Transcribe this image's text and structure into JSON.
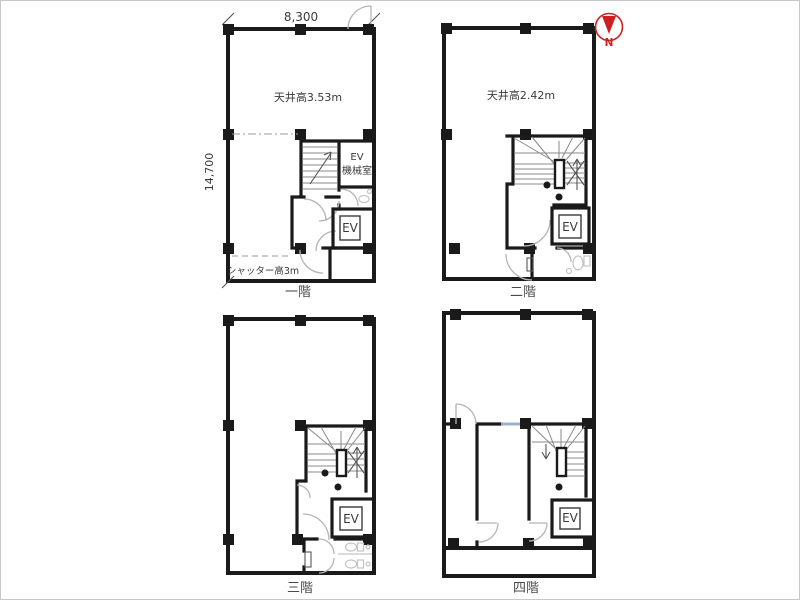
{
  "page": {
    "border_color": "#c8c8c8",
    "background": "#ffffff"
  },
  "colors": {
    "wall": "#1a1a1a",
    "stair_line": "#8a8a8a",
    "door_arc": "#b5b5b5",
    "fixture": "#c4c4c4",
    "dash": "#9a9a9a",
    "text": "#3a3a3a",
    "north_red": "#cc2020",
    "window_blue": "#9ab0cc",
    "border": "#c8c8c8"
  },
  "dimensions": {
    "width_label": "8,300",
    "height_label": "14,700"
  },
  "north_arrow": {
    "label": "N"
  },
  "floors": {
    "f1": {
      "name_label": "一階",
      "ceiling_height": "天井高3.53m",
      "shutter_note": "シャッター高3m",
      "ev_machine_room": {
        "line1": "EV",
        "line2": "機械室"
      },
      "elevator_label": "EV"
    },
    "f2": {
      "name_label": "二階",
      "ceiling_height": "天井高2.42m",
      "elevator_label": "EV"
    },
    "f3": {
      "name_label": "三階",
      "elevator_label": "EV"
    },
    "f4": {
      "name_label": "四階",
      "elevator_label": "EV"
    }
  }
}
